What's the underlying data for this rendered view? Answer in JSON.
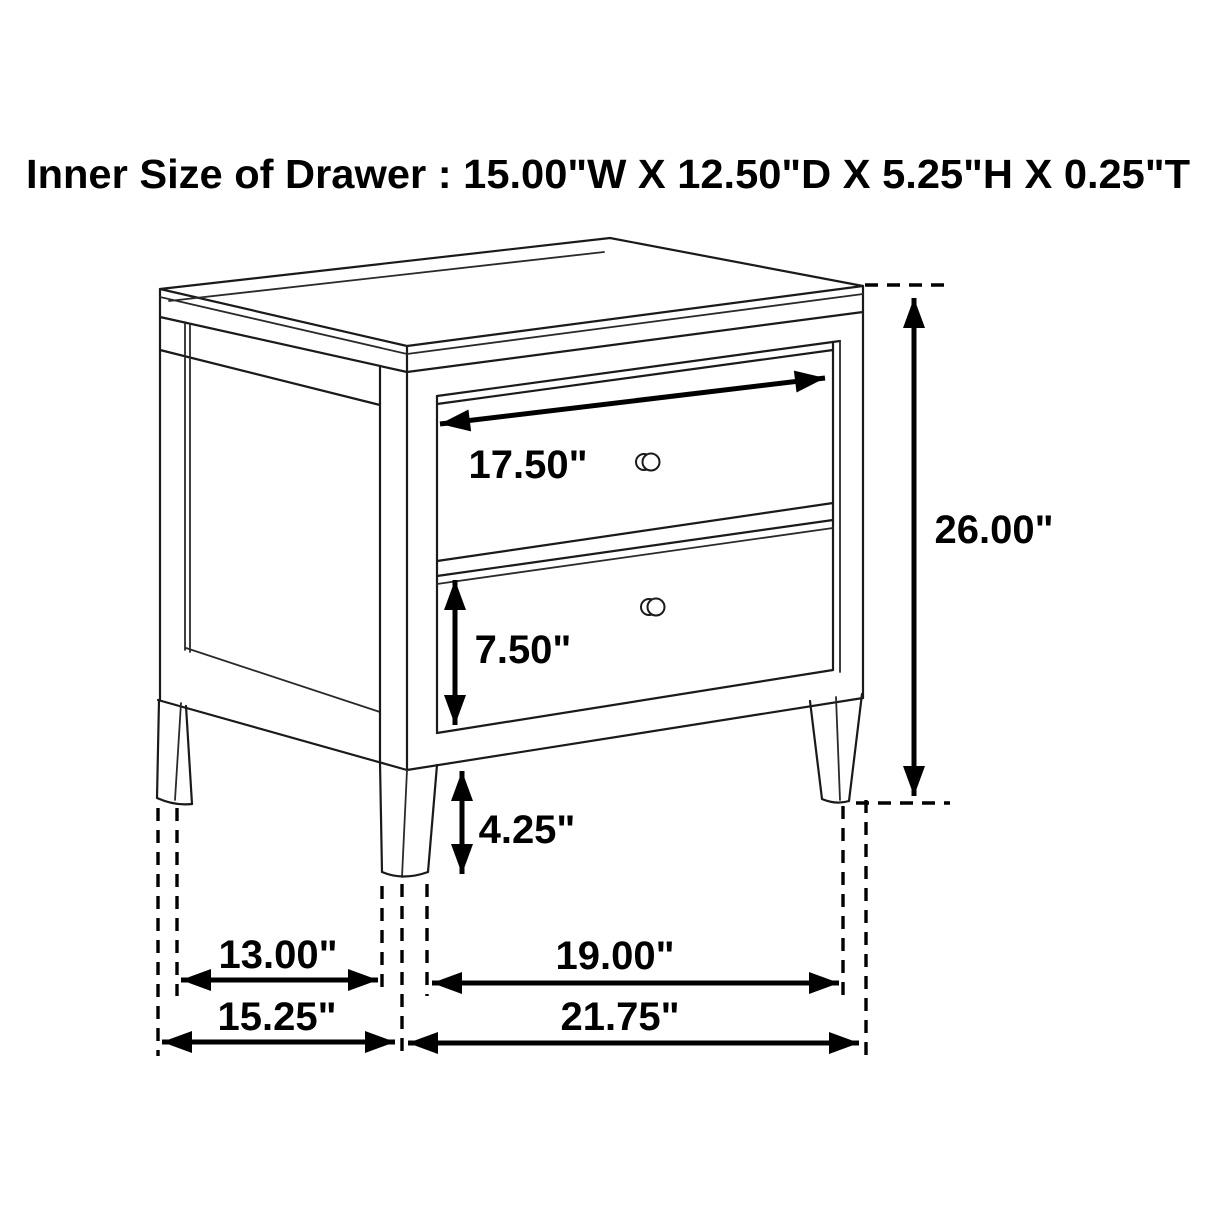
{
  "title": "Inner Size of Drawer : 15.00\"W X 12.50\"D X 5.25\"H X 0.25\"T",
  "diagram": {
    "subject": "two-drawer nightstand dimension drawing",
    "colors": {
      "line": "#000000",
      "background": "#ffffff"
    },
    "labels": {
      "drawer_front_width": "17.50\"",
      "overall_height": "26.00\"",
      "drawer_opening_height": "7.50\"",
      "leg_clearance_height": "4.25\"",
      "side_between_legs": "13.00\"",
      "side_overall_depth": "15.25\"",
      "front_between_legs": "19.00\"",
      "front_overall_width": "21.75\""
    },
    "inner_drawer_size": {
      "width": "15.00\"",
      "depth": "12.50\"",
      "height": "5.25\"",
      "thickness": "0.25\""
    }
  }
}
